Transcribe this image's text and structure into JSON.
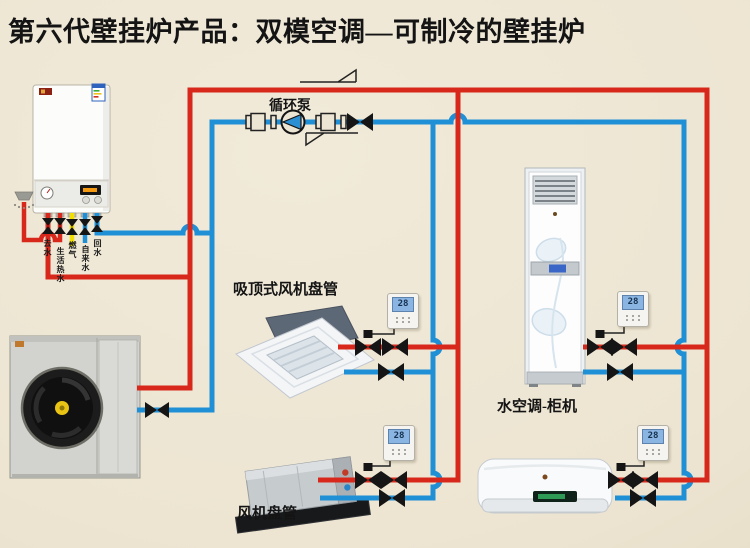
{
  "title": "第六代壁挂炉产品：双模空调—可制冷的壁挂炉",
  "labels": {
    "pump": "循环泵",
    "cassette": "吸顶式风机盘管",
    "fancoil": "风机盘管",
    "cabinet": "水空调-柜机"
  },
  "boiler_ports": [
    "去水",
    "生活热水",
    "燃气",
    "自来水",
    "回水"
  ],
  "thermostats": {
    "cassette": "28",
    "cabinet": "28",
    "fancoil": "28",
    "wall": "28"
  },
  "colors": {
    "supply_pipe": "#d8281b",
    "return_pipe": "#1f8fd6",
    "gas_pipe": "#f2de00",
    "background": "#ede5d2",
    "valve": "#151515"
  }
}
